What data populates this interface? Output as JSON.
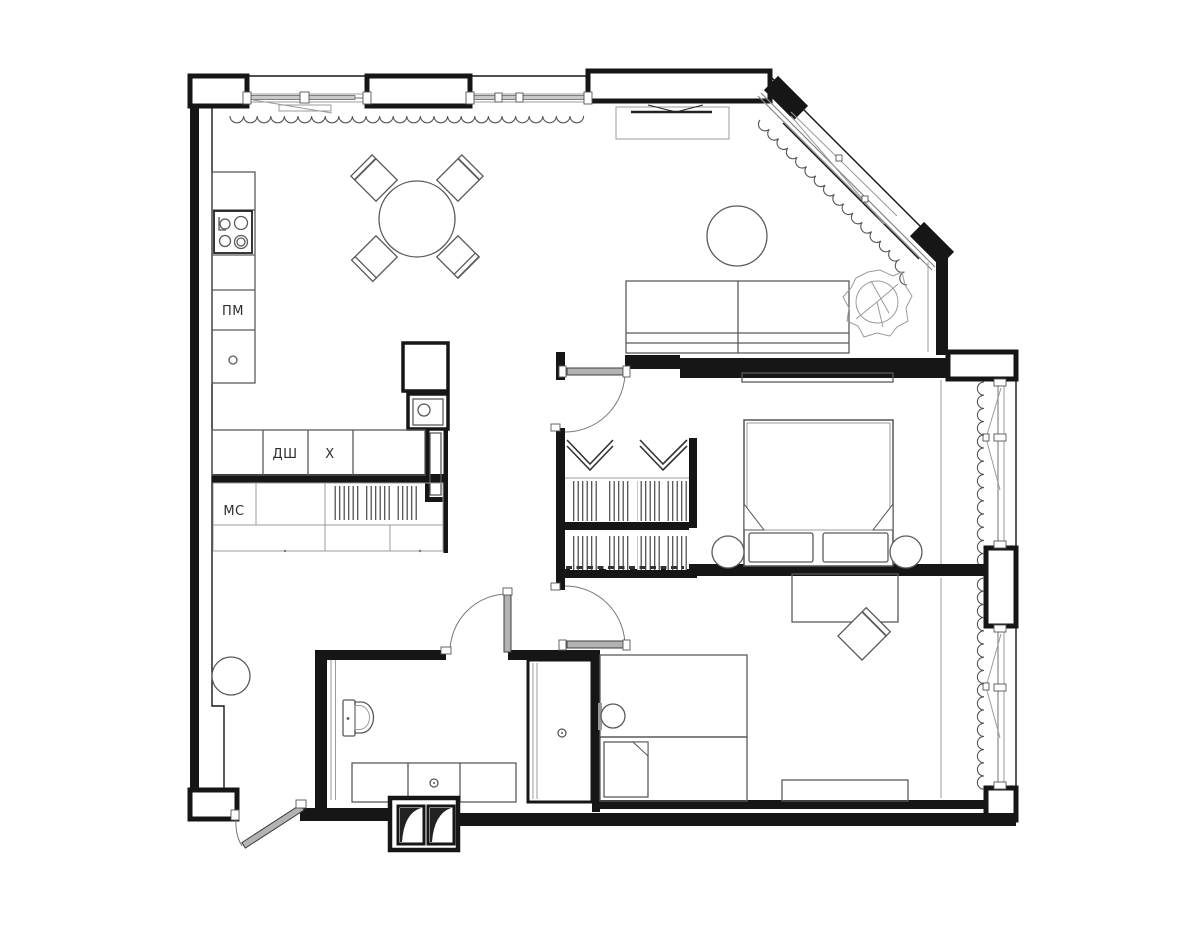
{
  "meta": {
    "drawing_type": "apartment floor plan, top view, black line work on white",
    "canvas": {
      "width": 1200,
      "height": 930
    }
  },
  "colors": {
    "wall": "#161616",
    "furniture_line": "#5a5a5a",
    "light_line": "#9b9b9b",
    "door_leaf": "#b3b3b3",
    "background": "#ffffff",
    "text": "#2e2e2e"
  },
  "labels": {
    "pm": "ПМ",
    "dsh": "ДШ",
    "kh": "Х",
    "ms": "МС"
  },
  "fixtures": [
    "cooktop",
    "kitchen-counter",
    "dining-table",
    "dining-chairs",
    "tv-stand",
    "sofa",
    "coffee-table",
    "plant",
    "wardrobe-racks",
    "hanger-symbols",
    "double-bed",
    "pillows",
    "poufs",
    "closet-rail",
    "toilet",
    "vanity-counter",
    "shower-cabin",
    "desk",
    "desk-chair",
    "single-beds",
    "dresser",
    "entry-pouf",
    "vent-shafts",
    "windows-with-curtains",
    "swing-doors",
    "pocket-door"
  ]
}
